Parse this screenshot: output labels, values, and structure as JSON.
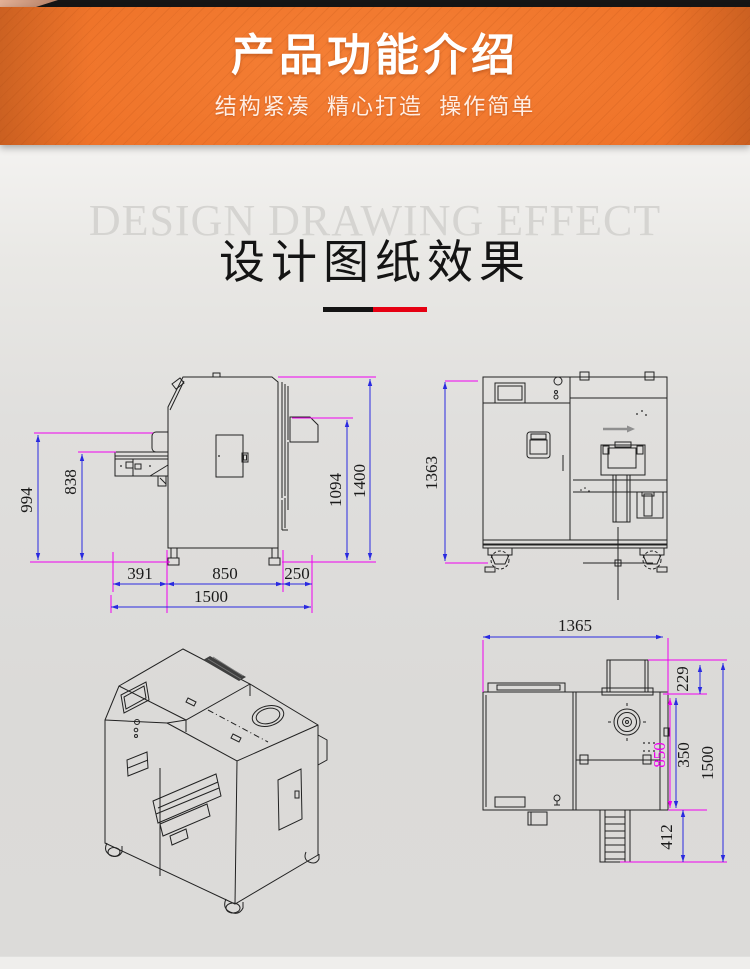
{
  "header": {
    "title": "产品功能介绍",
    "subtitle": "结构紧凑  精心打造  操作简单"
  },
  "section": {
    "watermark": "DESIGN DRAWING EFFECT",
    "title": "设计图纸效果"
  },
  "drawings": {
    "side_view": {
      "dims": {
        "height_left": "994",
        "height_tray": "838",
        "width_tray": "391",
        "width_body": "850",
        "width_right": "250",
        "width_total": "1500",
        "height_inner": "1094",
        "height_total": "1400"
      }
    },
    "front_view": {
      "dims": {
        "height_total": "1363"
      }
    },
    "plan_view": {
      "dims": {
        "width_total": "1365",
        "duct_depth": "229",
        "depth_body": "850",
        "depth_lower": "350",
        "depth_total": "1500",
        "conveyor_depth": "412"
      }
    }
  },
  "colors": {
    "banner_orange": "#ee7228",
    "divider_red": "#e60012",
    "dim_line_blue": "#2a2ae0",
    "extension_magenta": "#f000f0",
    "drawing_line": "#222222"
  }
}
